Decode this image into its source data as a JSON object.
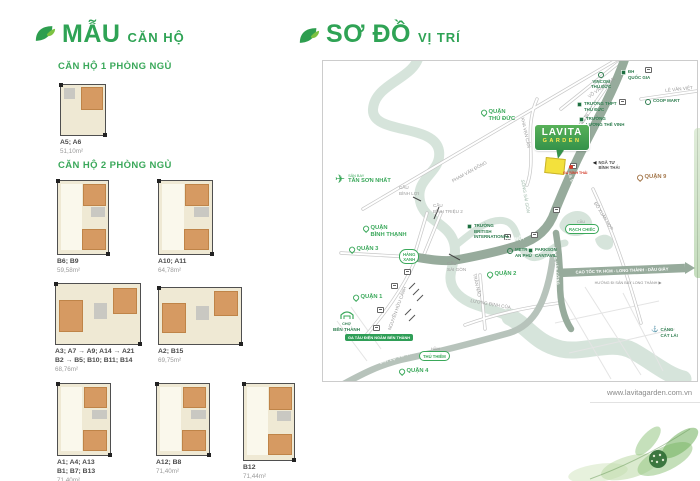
{
  "left_panel": {
    "title": {
      "main": "MẪU",
      "sub": "CĂN HỘ"
    },
    "section_1br": "CĂN HỘ 1 PHÒNG NGỦ",
    "section_2br": "CĂN HỘ 2 PHÒNG NGỦ",
    "plans": [
      {
        "units1": "A5; A6",
        "area": "51,10m²"
      },
      {
        "units1": "B6; B9",
        "area": "59,58m²"
      },
      {
        "units1": "A10; A11",
        "area": "64,78m²"
      },
      {
        "units1": "A3; A7 → A9; A14 → A21",
        "units2": "B2 → B5; B10; B11; B14",
        "area": "68,76m²"
      },
      {
        "units1": "A2; B15",
        "area": "69,75m²"
      },
      {
        "units1": "A1; A4; A13",
        "units2": "B1; B7; B13",
        "area": "71,40m²"
      },
      {
        "units1": "A12; B8",
        "area": "71,40m²"
      },
      {
        "units1": "B12",
        "area": "71,44m²"
      }
    ]
  },
  "right_panel": {
    "title": {
      "main": "SƠ ĐỒ",
      "sub": "VỊ TRÍ"
    },
    "website": "www.lavitagarden.com.vn",
    "map": {
      "project": {
        "name": "LAVITA",
        "brand": "GARDEN"
      },
      "districts": {
        "thu_duc": "QUẬN\nTHỦ ĐỨC",
        "binh_thanh": "QUẬN\nBÌNH THẠNH",
        "q1": "QUẬN 1",
        "q2": "QUẬN 2",
        "q3": "QUẬN 3",
        "q4": "QUẬN 4",
        "q9": "QUẬN 9"
      },
      "roads": {
        "pham_van_dong": "PHẠM VĂN ĐỒNG",
        "xa_lo_1": "XA LỘ HÀ NỘI",
        "xa_lo_2": "XA LỘ HÀ NỘI",
        "cao_toc": "CAO TỐC TP. HCM - LONG THÀNH - DẦU GIÂY",
        "cao_toc_note": "HƯỚNG ĐI SÂN BAY LONG THÀNH ▶",
        "vo_van_ngan": "VÕ VĂN NGÂN",
        "le_van_viet": "LÊ VĂN VIỆT",
        "kha_van_can": "KHA VẠN CÂN",
        "dang_van_bi": "ĐẶNG VĂN BI",
        "do_xuan_hop": "ĐỖ XUÂN HỢP",
        "nguyen_huu_canh": "NGUYỄN HỮU CẢNH",
        "tran_nao": "TRẦN NÃO",
        "luong_dinh_cua": "LƯƠNG ĐỊNH CỦA",
        "vo_van_kiet": "ĐẠI LỘ VÕ VĂN KIỆT",
        "dong_van_cong": "ĐỒNG VĂN CỐNG",
        "song_sai_gon": "SÔNG SÀI GÒN"
      },
      "bridges": {
        "binh_loi": "CẦU\nBÌNH LỢI",
        "binh_trieu_2": "CẦU\nBÌNH TRIỆU 2",
        "sai_gon": "CẦU\nSÀI GÒN",
        "rach_chiec_cap": "CẦU",
        "rach_chiec": "RẠCH CHIẾC",
        "thu_thiem_cap": "HẦM",
        "thu_thiem": "THỦ THIÊM",
        "hang_xanh": "HÀNG\nXANH"
      },
      "pois": {
        "airport_cap": "SÂN BAY",
        "airport": "TÂN SƠN NHẤT",
        "vincom": "VINCOM\nTHỦ ĐỨC",
        "dh_quoc_gia": "ĐH\nQUỐC GIA",
        "thpt_thu_duc": "TRƯỜNG THPT\nTHỦ ĐỨC",
        "luong_the_vinh": "TRƯỜNG\nLƯƠNG THẾ VINH",
        "coop_mart": "COOP MART",
        "british": "TRƯỜNG\nBRITISH\nINTERNATIONAL",
        "metro_an_phu": "METRO\nAN PHÚ",
        "parkson": "PARKSON\nCANTAVIL",
        "ben_thanh_cap": "CHỢ",
        "ben_thanh": "BẾN THÀNH",
        "metro_badge": "GA TÀU ĐIỆN NGẦM BẾN THÀNH",
        "cat_lai": "CẢNG\nCÁT LÁI",
        "binh_thai_junction": "NGÃ TƯ\nBÌNH THÁI",
        "binh_thai_station": "GA BÌNH THÁI"
      }
    }
  }
}
